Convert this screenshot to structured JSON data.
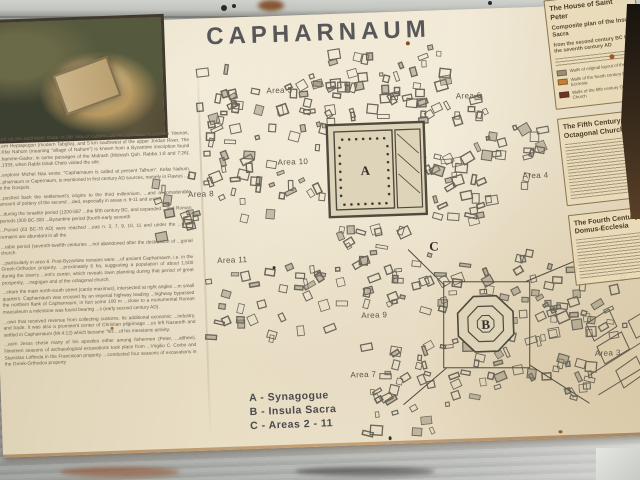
{
  "title": "CAPHARNAUM",
  "left_column": {
    "paragraphs": [
      "...ed on the northwest shore of the Sea of Galilee, 14 km northeast of modern Tiberias, ...ern Heptapegon (modern Tabgha), and 5 km southwest of the upper Jordan River. The ...Kfar Nahum (meaning \"village of Nahum\") is known from a Byzantine inscription found ...hamme-Gader; in some passages of the Midrash (Midrash Qoh. Rabba 1:8 and 7:26); ...1333, when Rabbi Ishak Chelo visited the site.",
      "...explorer Michel Nau wrote: \"Capharnaum is called at present Talhum\". Kefar Nahum, ...pharnaum or Capernaum, is mentioned in first century AD sources, namely in Flavius ...y in the Gospels.",
      "...pushed back the settlement's origins to the third millennium, ...and a considerable amount of pottery of the second ...ded, especially in areas n. 9-11 and under",
      "...during the Israelite period (1200-587 ...the fifth century BC, and expanded ...and Roman periods (300 BC-300 ...Byzantine period (fourth-early seventh",
      "...Period (63 BC-70 AD) were reached ...eas n. 3, 7, 9, 10, 11 and under the ...ntine remains are abundant in all the",
      "...rabic period (seventh-twelfth centuries ...not abandoned after the destruction of ...gonal church.",
      "...particularly in area 8. Post-Byzantine remains were ...of ancient Capharnaum, i.e. in the Greek-Orthodox property. ...proximately 6 ha, suggesting a population of about 1,500 during the town's ...ent's center, which reveals town planning during that period of great prosperity, ...nagogue and of the octagonal church.",
      "...share the main north-south street (cardo maximus), intersected at right angles ...m small quarters. Capharnaum was crossed by an imperial highway leading ...highway bypassed the northern flank of Capharnaum; in fact some 100 m ...close to a monumental Roman mausoleum a milestone was found bearing ...s (early second century AD).",
      "...own that received revenue from collecting customs. Its additional economic ...industry, and trade. It was also a prominent center of Christian pilgrimage ...us left Nazareth and settled in Capharnaum (Mt 4:12) which became \"his ...of his messianic activity.",
      "...aum Jesus chose many of his apostles either among fishermen (Peter, ...atthew). Nineteen seasons of archaeological excavations took place from ...Virgilio C. Corbo and Stanislao Loffreda in the Franciscan property. ...conducted four seasons of excavations in the Greek-Orthodox property"
    ]
  },
  "map": {
    "area_labels": [
      {
        "text": "Area 5",
        "x": 139,
        "y": 47
      },
      {
        "text": "Area 6",
        "x": 328,
        "y": 59
      },
      {
        "text": "Area 4",
        "x": 392,
        "y": 141
      },
      {
        "text": "Area 10",
        "x": 150,
        "y": 119
      },
      {
        "text": "Area 8",
        "x": 57,
        "y": 148
      },
      {
        "text": "Area 11",
        "x": 86,
        "y": 215
      },
      {
        "text": "Area 9",
        "x": 226,
        "y": 275
      },
      {
        "text": "Area 7",
        "x": 213,
        "y": 334
      },
      {
        "text": "Area 3",
        "x": 458,
        "y": 321
      }
    ],
    "markers": [
      {
        "text": "A",
        "x": 222,
        "y": 132
      },
      {
        "text": "B",
        "x": 337,
        "y": 290
      },
      {
        "text": "C",
        "x": 288,
        "y": 210
      }
    ]
  },
  "legend": {
    "items": [
      "A - Synagogue",
      "B - Insula Sacra",
      "C - Areas 2 - 11"
    ]
  },
  "sidebar": {
    "panels": [
      {
        "heading": "The House of Saint Peter",
        "subheading": "Composite plan of the Insula Sacra",
        "caption": "from the second century BC to the seventh century AD",
        "legend": [
          {
            "color": "#9a8e76",
            "label": "Walls of original layout of the area"
          },
          {
            "color": "#c67f35",
            "label": "Walls of the fourth century Domus Ecclesia"
          },
          {
            "color": "#6d3524",
            "label": "Walls of the fifth century Octagonal Church"
          }
        ]
      },
      {
        "heading": "The Fifth Century Octagonal Church"
      },
      {
        "heading": "The Fourth Century Domus-Ecclesia"
      }
    ]
  },
  "colors": {
    "board_cream": "#e7dcc0",
    "title_ink": "#4b4b4f",
    "map_ink": "#6b665a",
    "rust": "#8a4a1e"
  }
}
